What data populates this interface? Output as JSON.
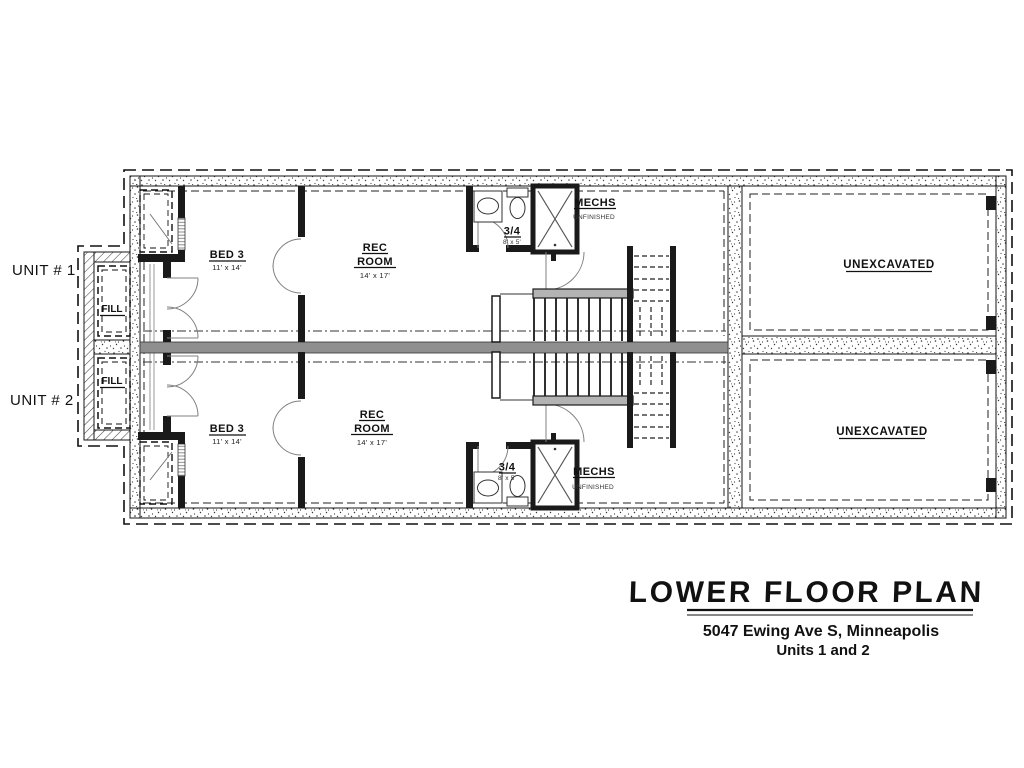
{
  "plan": {
    "unit1": {
      "unit_label": "UNIT # 1",
      "fill_label": "FILL",
      "bed": {
        "name": "BED 3",
        "size": "11' x 14'"
      },
      "rec": {
        "line1": "REC",
        "line2": "ROOM",
        "size": "14' x 17'"
      },
      "bath": {
        "name": "3/4",
        "size": "8' x 5'"
      },
      "mech": {
        "name": "MECHS",
        "status": "UNFINISHED"
      },
      "unexcavated": "UNEXCAVATED"
    },
    "unit2": {
      "unit_label": "UNIT # 2",
      "fill_label": "FILL",
      "bed": {
        "name": "BED 3",
        "size": "11' x 14'"
      },
      "rec": {
        "line1": "REC",
        "line2": "ROOM",
        "size": "14' x 17'"
      },
      "bath": {
        "name": "3/4",
        "size": "8' x 5'"
      },
      "mech": {
        "name": "MECHS",
        "status": "UNFINISHED"
      },
      "unexcavated": "UNEXCAVATED"
    }
  },
  "title_block": {
    "title": "LOWER FLOOR PLAN",
    "address": "5047 Ewing Ave S, Minneapolis",
    "units": "Units 1 and 2"
  },
  "colors": {
    "wall_black": "#1a1a1a",
    "party_wall_gray": "#8f8f8f",
    "rail_gray": "#b3b3b3",
    "door_line": "#808080",
    "background": "#ffffff"
  }
}
